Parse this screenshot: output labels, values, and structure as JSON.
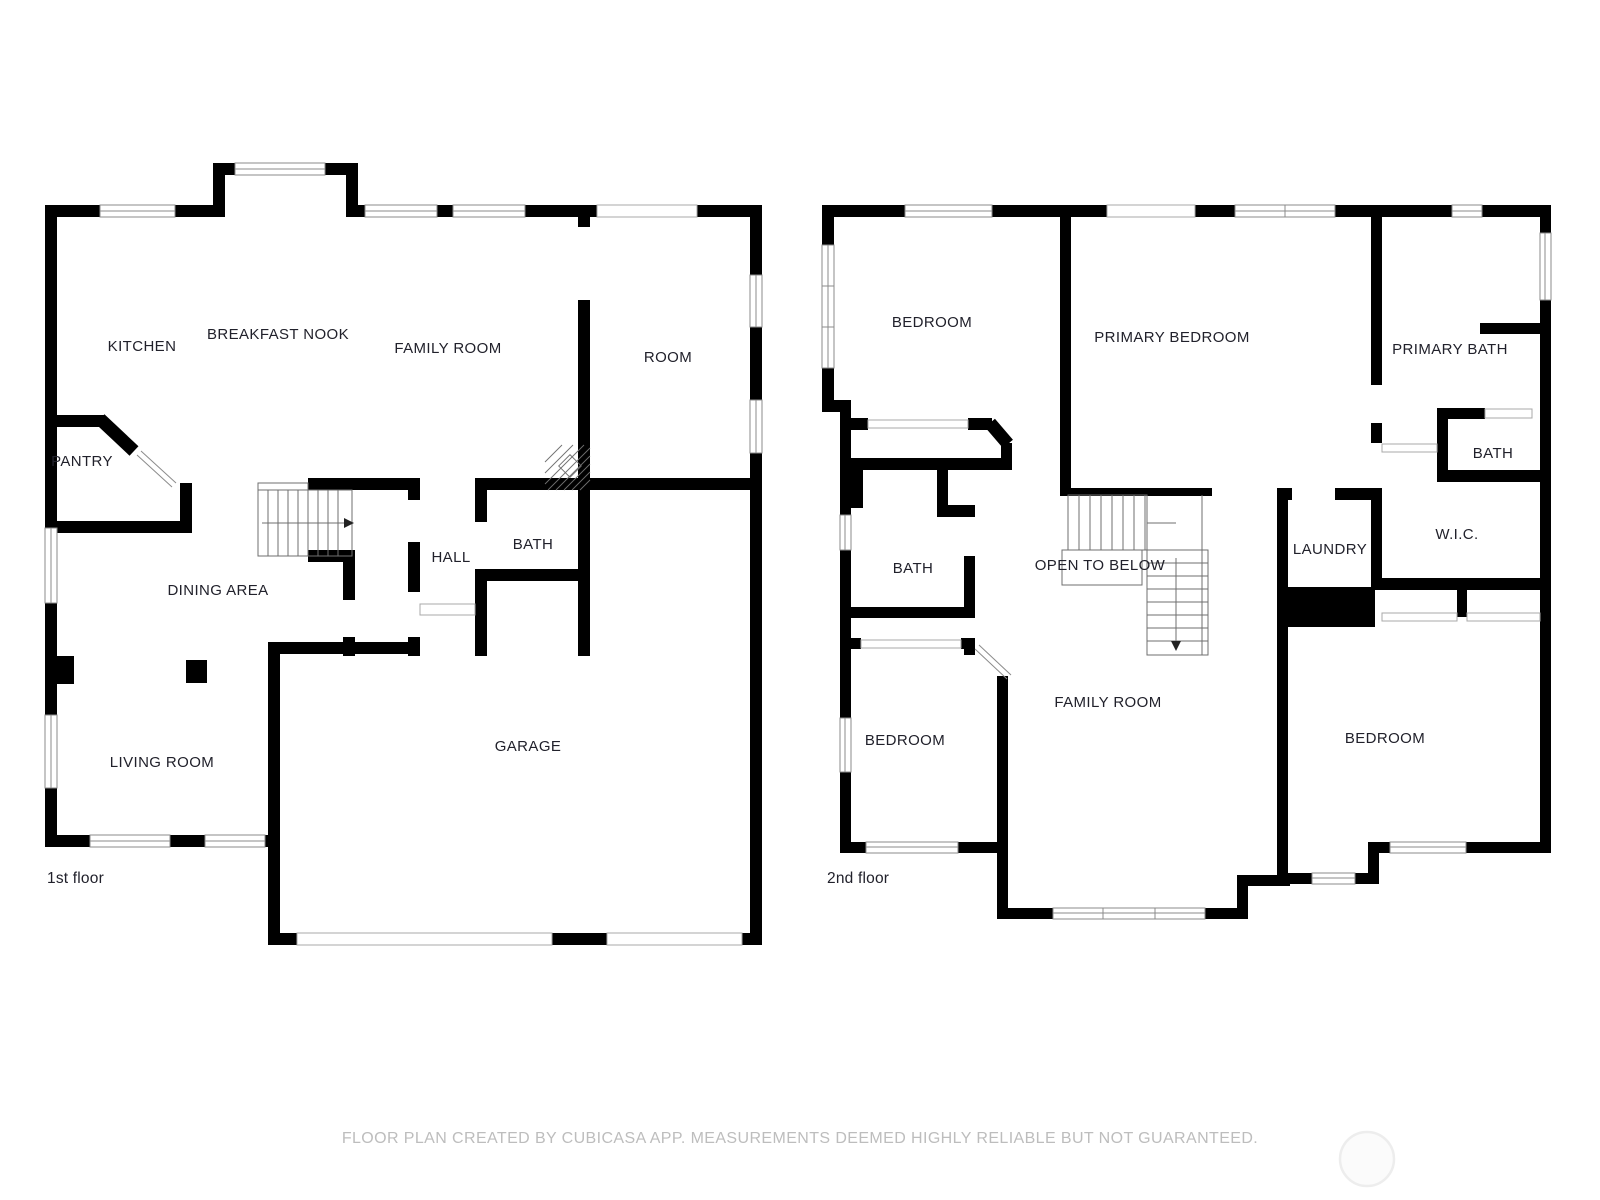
{
  "page": {
    "background": "#ffffff",
    "type": "floor-plan-sheet"
  },
  "floors": [
    {
      "label": "1st floor",
      "rooms": [
        {
          "name": "KITCHEN"
        },
        {
          "name": "BREAKFAST NOOK"
        },
        {
          "name": "FAMILY ROOM"
        },
        {
          "name": "ROOM"
        },
        {
          "name": "PANTRY"
        },
        {
          "name": "HALL"
        },
        {
          "name": "BATH"
        },
        {
          "name": "DINING AREA"
        },
        {
          "name": "LIVING ROOM"
        },
        {
          "name": "GARAGE"
        }
      ]
    },
    {
      "label": "2nd floor",
      "rooms": [
        {
          "name": "BEDROOM"
        },
        {
          "name": "PRIMARY BEDROOM"
        },
        {
          "name": "PRIMARY BATH"
        },
        {
          "name": "BATH"
        },
        {
          "name": "BATH"
        },
        {
          "name": "OPEN TO BELOW"
        },
        {
          "name": "LAUNDRY"
        },
        {
          "name": "W.I.C."
        },
        {
          "name": "BEDROOM"
        },
        {
          "name": "FAMILY ROOM"
        },
        {
          "name": "BEDROOM"
        }
      ]
    }
  ],
  "footer": {
    "disclaimer": "FLOOR PLAN CREATED BY CUBICASA APP. MEASUREMENTS DEEMED HIGHLY RELIABLE BUT NOT GUARANTEED."
  },
  "colors": {
    "wall": "#000000",
    "room_label": "#21212b",
    "floor_label": "#21212b",
    "footer_text": "#bdbdbd",
    "window_stroke": "#8b8b8b",
    "watermark": "#ededed"
  }
}
